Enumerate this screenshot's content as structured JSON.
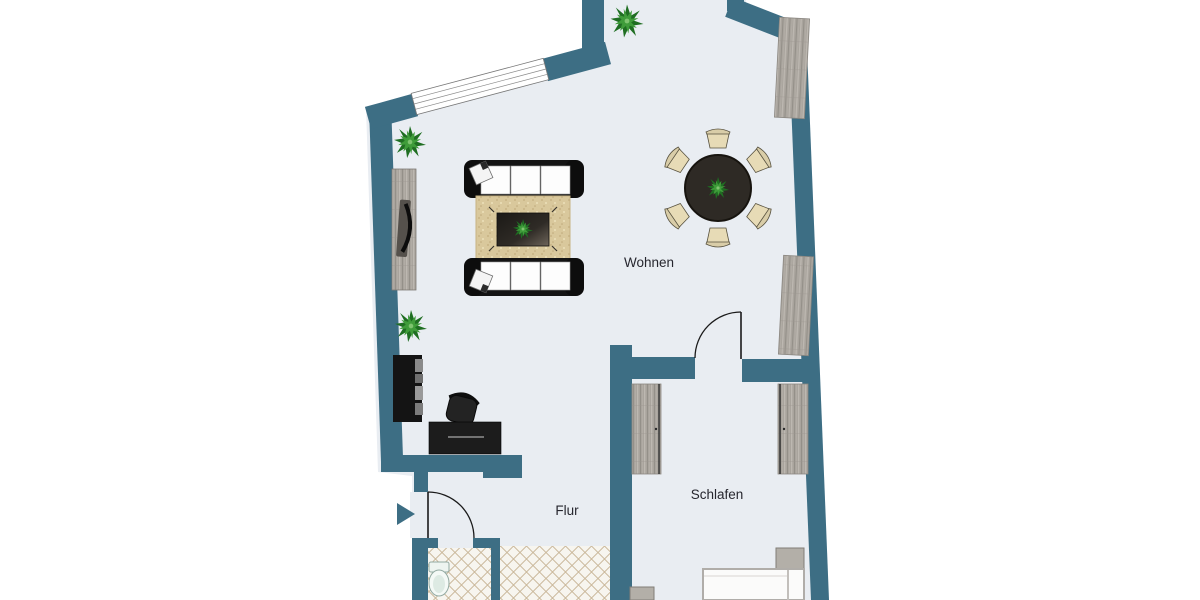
{
  "plan": {
    "type": "apartment-floorplan",
    "language": "de",
    "rooms": [
      {
        "label": "Wohnen"
      },
      {
        "label": "Flur"
      },
      {
        "label": "Schlafen"
      }
    ]
  },
  "colors": {
    "wall": "#3d6e84",
    "floor": "#e9edf2",
    "background": "#ffffff",
    "wood_furniture": "#a9a49d",
    "rug": "#d9c89c",
    "tile_line": "#c9b698",
    "tile_background": "#f7f5ef",
    "dark_furniture": "#1c1c1c",
    "chair_beige": "#e7dbb6",
    "plant_green": "#2e8b2e",
    "label_text": "#26262e"
  },
  "icons": [
    "entrance-arrow-icon",
    "window-icon",
    "door-swing-icon",
    "plant-icon",
    "sofa-icon",
    "coffee-table-icon",
    "rug-icon",
    "dining-table-icon",
    "dining-chair-icon",
    "tv-sideboard-icon",
    "tv-icon",
    "bookshelf-icon",
    "desk-icon",
    "office-chair-icon",
    "wardrobe-icon",
    "bed-icon",
    "nightstand-icon",
    "toilet-icon"
  ]
}
